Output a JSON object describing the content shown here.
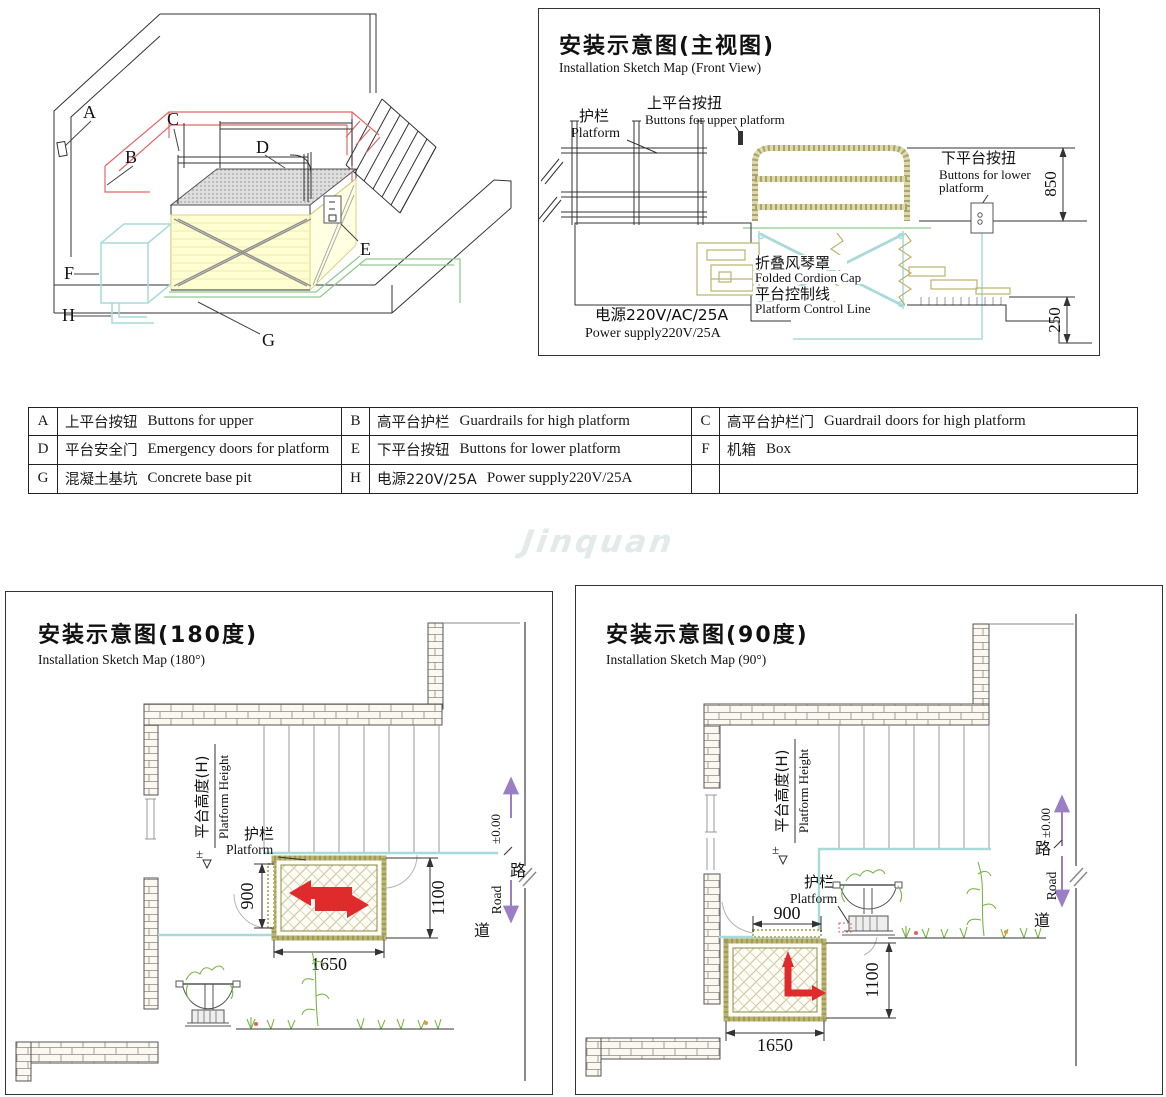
{
  "colors": {
    "direction_arrow_red": "#df2b2b",
    "guardrail_wall_red": "#e06868",
    "accordion_yellow": "#ffffd2",
    "control_line_cyan": "#a9dada",
    "rail_khaki": "#b9b56e",
    "pit_outline_green": "#8fcb8f",
    "road_arrow_purple": "#9b7fc4",
    "plant_green": "#7ab648",
    "brick_fill": "#faf8f0",
    "watermark_gray": "#e3eaea"
  },
  "iso": {
    "labels": [
      "A",
      "B",
      "C",
      "D",
      "E",
      "F",
      "G",
      "H"
    ]
  },
  "front": {
    "title_cn": "安装示意图(主视图)",
    "title_en": "Installation Sketch Map (Front View)",
    "guardrail_cn": "护栏",
    "guardrail_en": "Platform",
    "upper_btn_cn": "上平台按扭",
    "upper_btn_en": "Buttons for upper platform",
    "lower_btn_cn": "下平台按扭",
    "lower_btn_en1": "Buttons for lower",
    "lower_btn_en2": "platform",
    "cordion_cn": "折叠风琴罩",
    "cordion_en": "Folded Cordion Cap",
    "control_cn": "平台控制线",
    "control_en": "Platform Control Line",
    "power_cn": "电源220V/AC/25A",
    "power_en": "Power supply220V/25A",
    "dim_850": "850",
    "dim_250": "250"
  },
  "legend": {
    "rows": [
      [
        {
          "key": "A",
          "cn": "上平台按钮",
          "en": "Buttons for upper"
        },
        {
          "key": "B",
          "cn": "高平台护栏",
          "en": "Guardrails for high platform"
        },
        {
          "key": "C",
          "cn": "高平台护栏门",
          "en": "Guardrail doors for high platform"
        }
      ],
      [
        {
          "key": "D",
          "cn": "平台安全门",
          "en": "Emergency doors for platform"
        },
        {
          "key": "E",
          "cn": "下平台按钮",
          "en": "Buttons for lower platform"
        },
        {
          "key": "F",
          "cn": "机箱",
          "en": "Box"
        }
      ],
      [
        {
          "key": "G",
          "cn": "混凝土基坑",
          "en": "Concrete base pit"
        },
        {
          "key": "H",
          "cn": "电源220V/25A",
          "en": "Power supply220V/25A"
        },
        {
          "key": "",
          "cn": "",
          "en": ""
        }
      ]
    ]
  },
  "watermark": "Jinquan",
  "map180": {
    "title_cn": "安装示意图(180度)",
    "title_en": "Installation Sketch Map (180°)",
    "height_cn": "平台高度(H)",
    "height_en": "Platform Height",
    "level_sym": "±",
    "guardrail_cn": "护栏",
    "guardrail_en": "Platform",
    "dim_900": "900",
    "dim_1100": "1100",
    "dim_1650": "1650",
    "level": "±0.00",
    "road_cn_top": "路",
    "road_en": "Road",
    "road_cn_bottom": "道"
  },
  "map90": {
    "title_cn": "安装示意图(90度)",
    "title_en": "Installation Sketch Map (90°)",
    "height_cn": "平台高度(H)",
    "height_en": "Platform Height",
    "level_sym": "±",
    "guardrail_cn": "护栏",
    "guardrail_en": "Platform",
    "dim_900": "900",
    "dim_1100": "1100",
    "dim_1650": "1650",
    "level": "±0.00",
    "road_cn_top": "路",
    "road_en": "Road",
    "road_cn_bottom": "道"
  }
}
